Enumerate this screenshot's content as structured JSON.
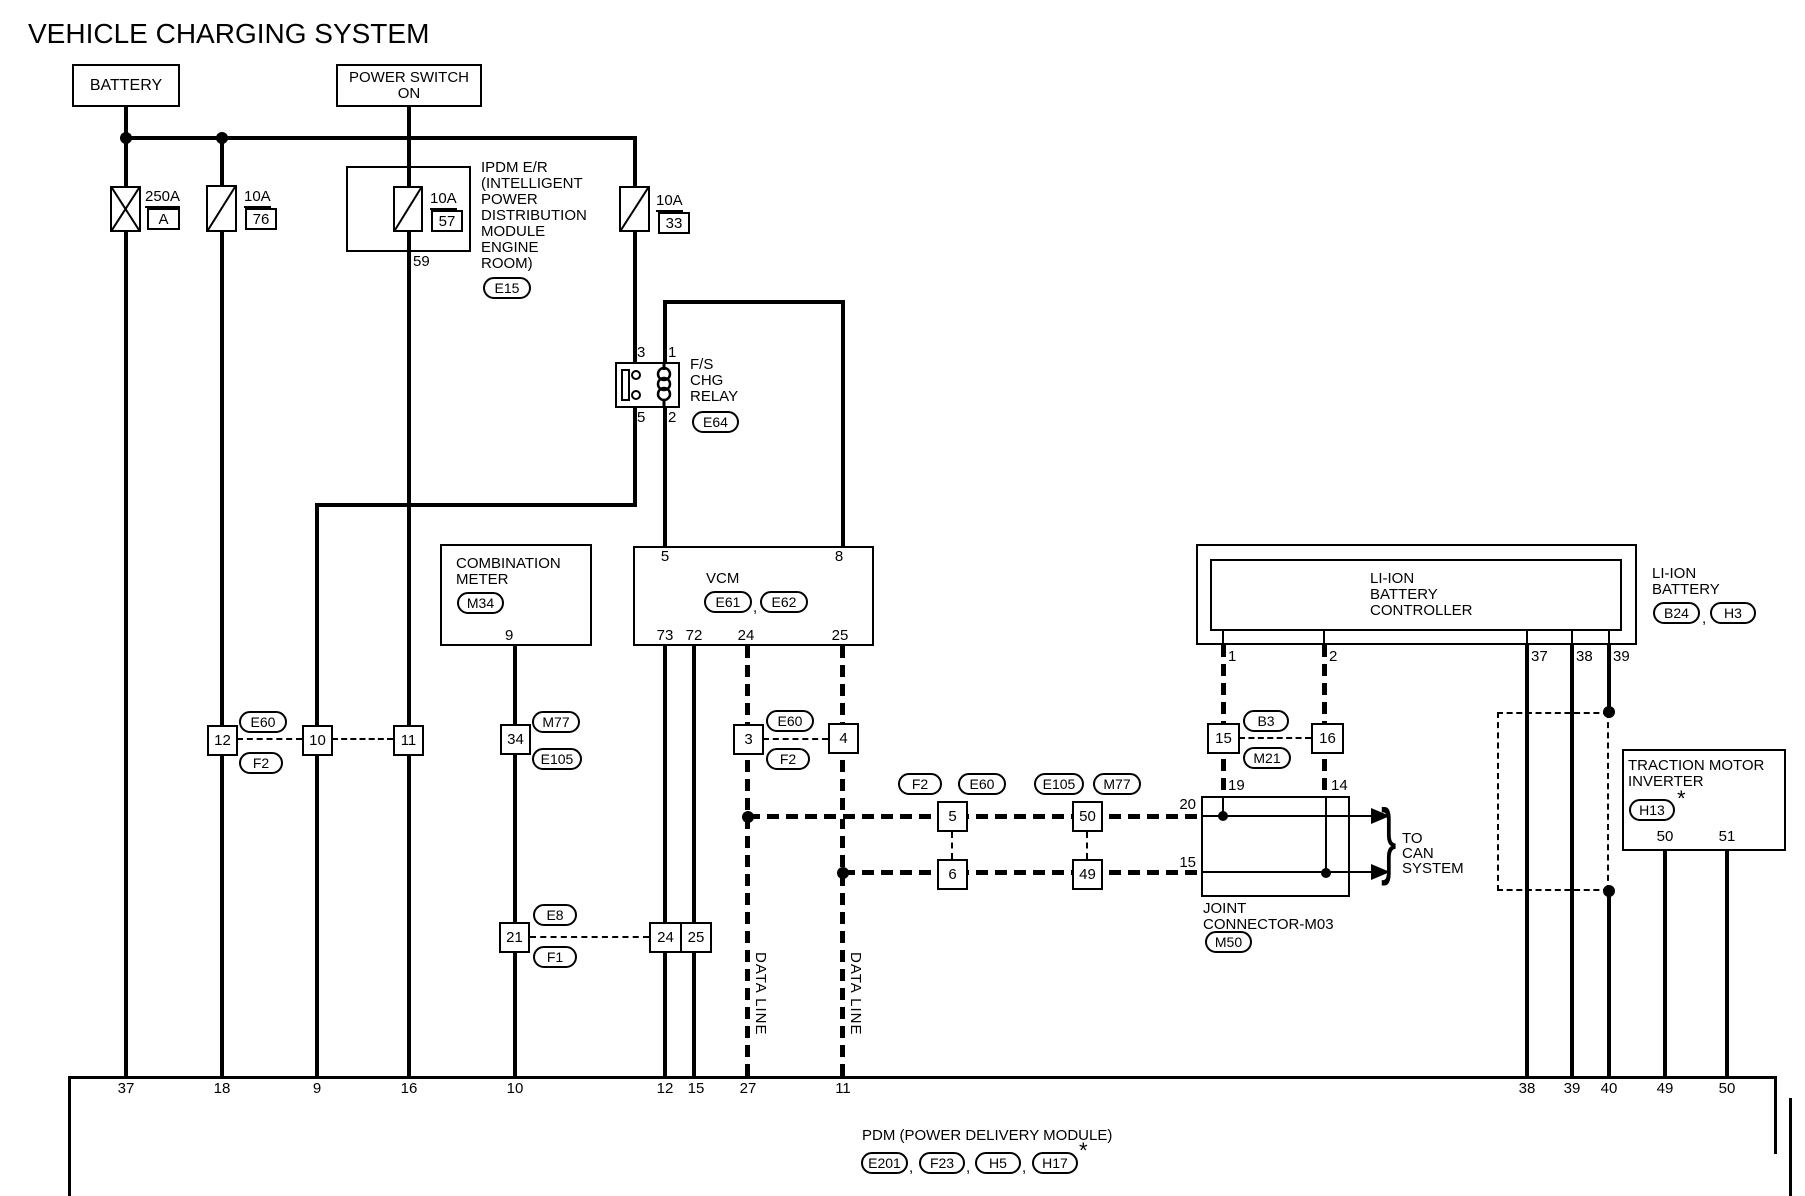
{
  "title": "VEHICLE CHARGING SYSTEM",
  "punct": {
    "comma": ",",
    "asterisk": "*",
    "brace": "}"
  },
  "components": {
    "battery": {
      "label": "BATTERY"
    },
    "power_switch": {
      "label": "POWER SWITCH\nON"
    },
    "ipdm": {
      "label": "IPDM E/R\n(INTELLIGENT\nPOWER\nDISTRIBUTION\nMODULE\nENGINE\nROOM)",
      "connector": "E15",
      "pin": "59"
    },
    "relay": {
      "label": "F/S\nCHG\nRELAY",
      "connector": "E64",
      "pin_top_left": "3",
      "pin_top_right": "1",
      "pin_bottom_left": "5",
      "pin_bottom_right": "2"
    },
    "meter": {
      "label": "COMBINATION\nMETER",
      "connector": "M34",
      "pin": "9"
    },
    "vcm": {
      "label": "VCM",
      "connector1": "E61",
      "connector2": "E62",
      "pin_top_left": "5",
      "pin_top_right": "8",
      "pins_bottom": [
        "73",
        "72",
        "24",
        "25"
      ]
    },
    "controller": {
      "label": "LI-ION\nBATTERY\nCONTROLLER",
      "pins": [
        "1",
        "2",
        "37",
        "38",
        "39"
      ]
    },
    "li_ion_battery": {
      "label": "LI-ION\nBATTERY",
      "connector1": "B24",
      "connector2": "H3"
    },
    "joint_connector": {
      "label": "JOINT\nCONNECTOR-M03",
      "connector": "M50",
      "pin_19": "19",
      "pin_14": "14",
      "pin_20": "20",
      "pin_15": "15"
    },
    "inverter": {
      "label": "TRACTION MOTOR\nINVERTER",
      "connector": "H13",
      "pin_50": "50",
      "pin_51": "51"
    },
    "pdm": {
      "label": "PDM (POWER DELIVERY MODULE)",
      "connectors": [
        "E201",
        "F23",
        "H5",
        "H17"
      ]
    }
  },
  "fuses": {
    "f250": {
      "rating": "250A",
      "id": "A"
    },
    "f76": {
      "rating": "10A",
      "id": "76"
    },
    "f57": {
      "rating": "10A",
      "id": "57"
    },
    "f33": {
      "rating": "10A",
      "id": "33"
    }
  },
  "inline_pins": {
    "p12": "12",
    "p10": "10",
    "p11": "11",
    "p34": "34",
    "p3": "3",
    "p4": "4",
    "p21": "21",
    "p24": "24",
    "p25": "25",
    "p5": "5",
    "p6": "6",
    "p50": "50",
    "p49": "49",
    "p15": "15",
    "p16": "16"
  },
  "connector_ovals": {
    "E60": "E60",
    "F2": "F2",
    "M77": "M77",
    "E105": "E105",
    "E8": "E8",
    "F1": "F1",
    "B3": "B3",
    "M21": "M21",
    "M50": "M50"
  },
  "can": {
    "data_line": "DATA LINE",
    "to_can": "TO\nCAN\nSYSTEM"
  },
  "bottom_pins": [
    "37",
    "18",
    "9",
    "16",
    "10",
    "12",
    "15",
    "27",
    "11",
    "38",
    "39",
    "40",
    "49",
    "50"
  ]
}
